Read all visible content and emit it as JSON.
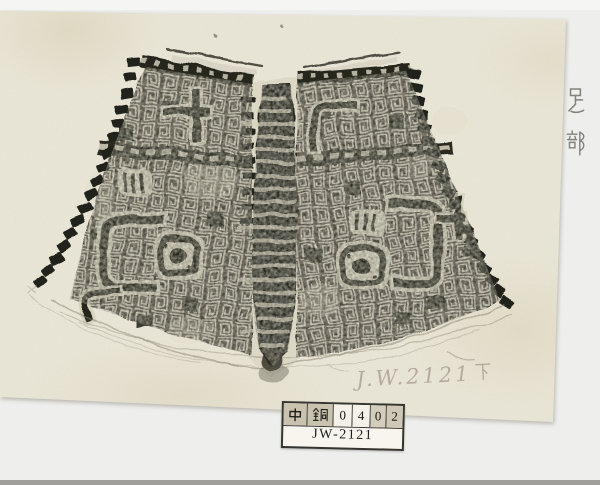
{
  "scan": {
    "description": "ink rubbing of a bronze bell foot section on archival backing sheet",
    "colors": {
      "backing_paper": "#eeeeec",
      "rubbing_paper": "#e9e5d6",
      "ink": "#26241e",
      "pencil": "#74746d",
      "handwriting": "#b4a89d",
      "bottom_strip": "#a09f9b"
    }
  },
  "annotations": {
    "side_note": "足部",
    "handwritten_id": "J.W.2121下",
    "handwritten_id_latin": "J.W.2121",
    "handwritten_id_suffix": "下"
  },
  "catalog_label": {
    "cells": [
      "中",
      "銅",
      "0",
      "4",
      "0",
      "2"
    ],
    "code": "JW-2121"
  }
}
